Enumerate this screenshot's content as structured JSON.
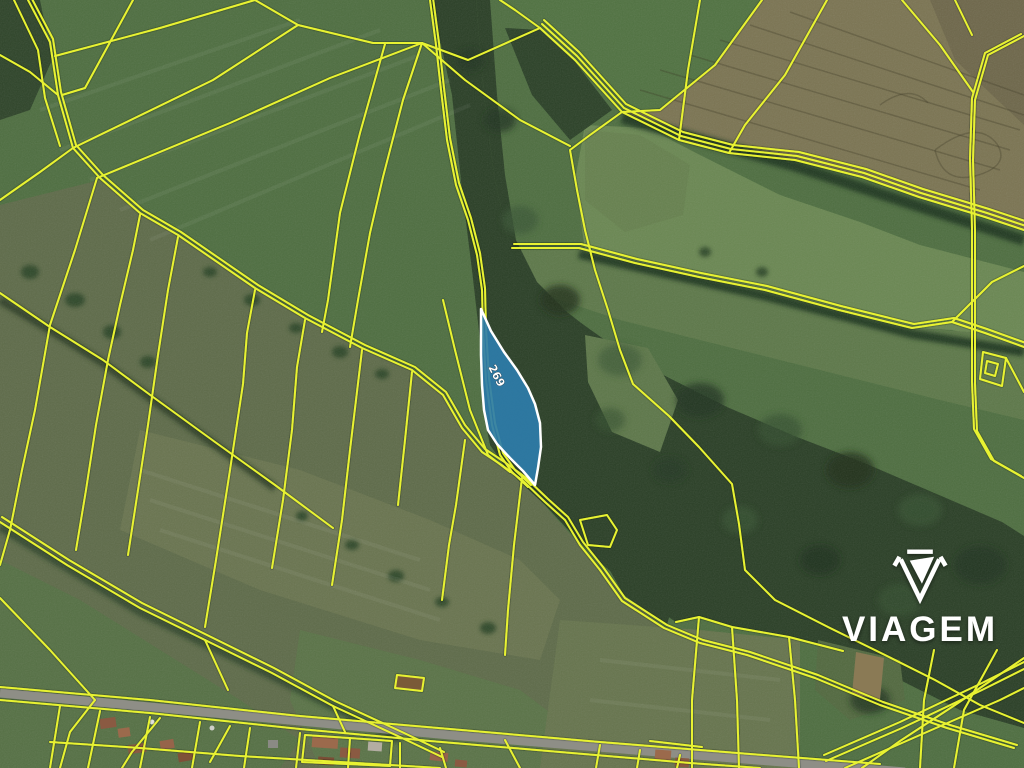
{
  "map": {
    "kind": "cadastral-satellite-view",
    "highlighted_parcel": {
      "label": "269",
      "fill_color": "#2e7dab",
      "border_color": "#ffffff",
      "label_color": "#ffffff"
    },
    "cadastral_lines_color": "#e8f232",
    "logo": {
      "text": "VIAGEM",
      "color": "#ffffff"
    }
  },
  "terrain": {
    "field_green": "#4e6e40",
    "field_olive": "#5e6b49",
    "meadow_green": "#6a8752",
    "forest_green": "#2a3f26",
    "plowed_brown": "#7b7452",
    "road_gray": "#8e8e86"
  }
}
